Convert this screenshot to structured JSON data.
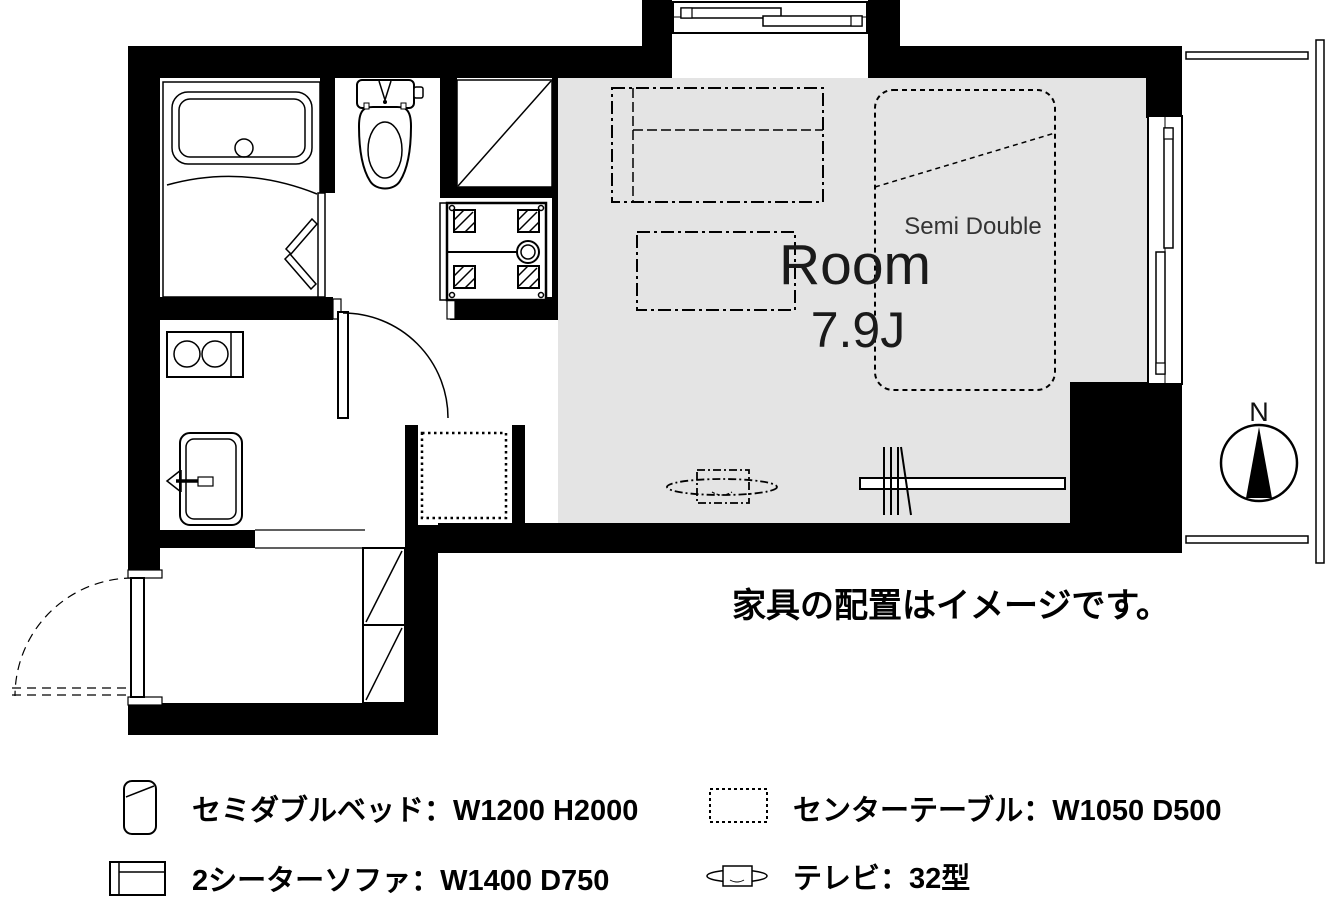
{
  "floor_plan": {
    "room": {
      "label": "Room",
      "size_label": "7.9J"
    },
    "bed_size_label": "Semi Double",
    "compass_north_label": "N",
    "furniture_notice": "家具の配置はイメージです。",
    "colors": {
      "wall_black": "#000000",
      "room_floor_gray": "#e4e4e4"
    }
  },
  "legend": {
    "items": [
      {
        "icon": "semi-double-bed-icon",
        "label": "セミダブルベッド：W1200 H2000"
      },
      {
        "icon": "two-seater-sofa-icon",
        "label": "2シーターソファ：W1400 D750"
      },
      {
        "icon": "center-table-icon",
        "label": "センターテーブル：W1050 D500"
      },
      {
        "icon": "tv-icon",
        "label": "テレビ：32型"
      }
    ]
  }
}
